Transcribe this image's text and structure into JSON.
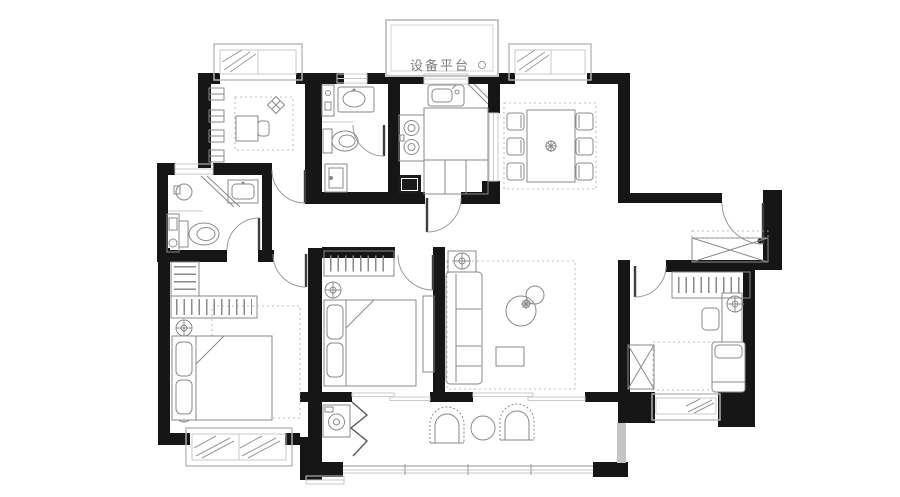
{
  "plan": {
    "platform_label": "设备平台",
    "canvas": {
      "width": 900,
      "height": 497,
      "background": "#ffffff"
    },
    "colors": {
      "wall": "#161616",
      "window_frame": "#b9b9b9",
      "furniture_line": "#8a8a8a",
      "door_leaf": "#3d3d3d",
      "door_arc": "#9a9a9a",
      "label_text": "#7d7d7d"
    },
    "rooms": [
      "study",
      "bathroom-small",
      "bathroom-master",
      "kitchen",
      "dining-room",
      "entry-hall",
      "living-room",
      "master-bedroom",
      "middle-bedroom",
      "right-bedroom",
      "balcony",
      "equipment-platform"
    ]
  }
}
